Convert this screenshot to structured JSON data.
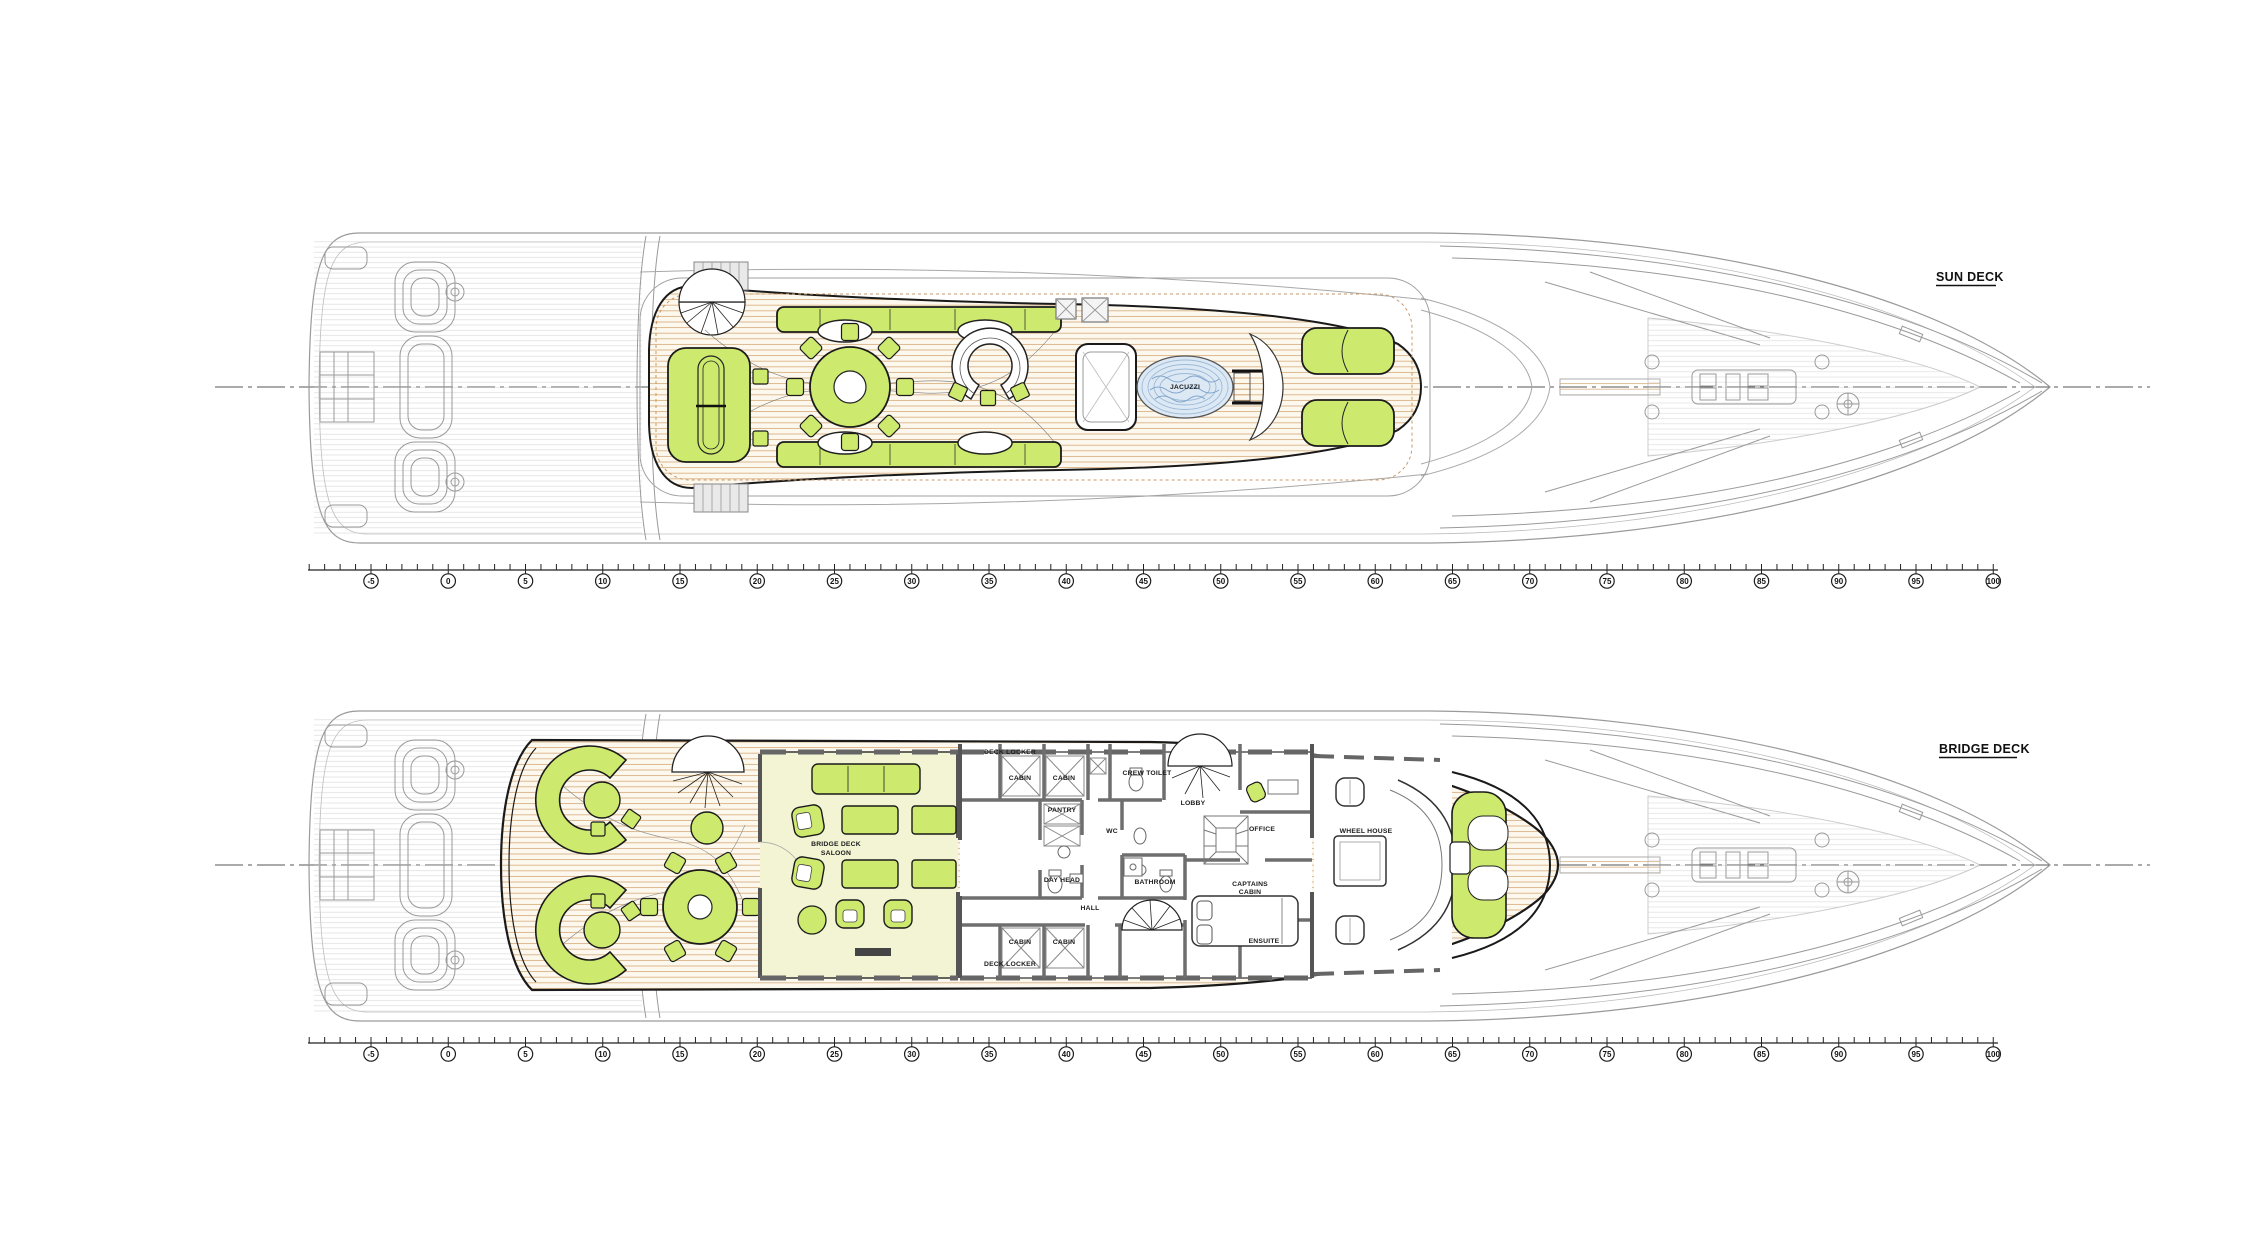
{
  "drawing": {
    "kind": "yacht general arrangement plan, top view, bow pointing right",
    "sheet_background": "#ffffff"
  },
  "decks": [
    {
      "id": "sun-deck",
      "label": "SUN DECK"
    },
    {
      "id": "bridge-deck",
      "label": "BRIDGE DECK"
    }
  ],
  "frame_ruler": {
    "min": -5,
    "max": 100,
    "step": 5,
    "frames": [
      -5,
      0,
      5,
      10,
      15,
      20,
      25,
      30,
      35,
      40,
      45,
      50,
      55,
      60,
      65,
      70,
      75,
      80,
      85,
      90,
      95,
      100
    ]
  },
  "plan_labels": {
    "sun_deck": [
      {
        "text": "JACUZZI",
        "x": 1185,
        "y": 389
      }
    ],
    "bridge_deck": [
      {
        "text": "DECK LOCKER",
        "x": 1010,
        "y": 754
      },
      {
        "text": "CABIN",
        "x": 1020,
        "y": 780
      },
      {
        "text": "CABIN",
        "x": 1064,
        "y": 780
      },
      {
        "text": "CREW TOILET",
        "x": 1147,
        "y": 775
      },
      {
        "text": "LOBBY",
        "x": 1193,
        "y": 805
      },
      {
        "text": "PANTRY",
        "x": 1062,
        "y": 812
      },
      {
        "text": "WC",
        "x": 1112,
        "y": 833
      },
      {
        "text": "DAY HEAD",
        "x": 1062,
        "y": 882
      },
      {
        "text": "HALL",
        "x": 1090,
        "y": 910
      },
      {
        "text": "BATHROOM",
        "x": 1155,
        "y": 884
      },
      {
        "text": "CABIN",
        "x": 1020,
        "y": 944
      },
      {
        "text": "CABIN",
        "x": 1064,
        "y": 944
      },
      {
        "text": "DECK LOCKER",
        "x": 1010,
        "y": 966
      },
      {
        "text": "CAPTAINS",
        "x": 1250,
        "y": 886
      },
      {
        "text": "CABIN",
        "x": 1250,
        "y": 894
      },
      {
        "text": "ENSUITE",
        "x": 1264,
        "y": 943
      },
      {
        "text": "OFFICE",
        "x": 1262,
        "y": 831
      },
      {
        "text": "WHEEL HOUSE",
        "x": 1366,
        "y": 833
      },
      {
        "text": "BRIDGE DECK",
        "x": 836,
        "y": 846
      },
      {
        "text": "SALOON",
        "x": 836,
        "y": 855
      }
    ]
  },
  "colors": {
    "furniture_green": "#cde96e",
    "deck_fill": "#fdf8ee",
    "deck_plank_line": "#d1a672",
    "interior_floor": "#f2f4d3",
    "jacuzzi_water": "#dce9f5",
    "jacuzzi_wave": "#7fa3c9",
    "outline_black": "#1a1a1a",
    "ghost_gray": "#9a9a9a",
    "wall_gray": "#6e6e6e"
  }
}
